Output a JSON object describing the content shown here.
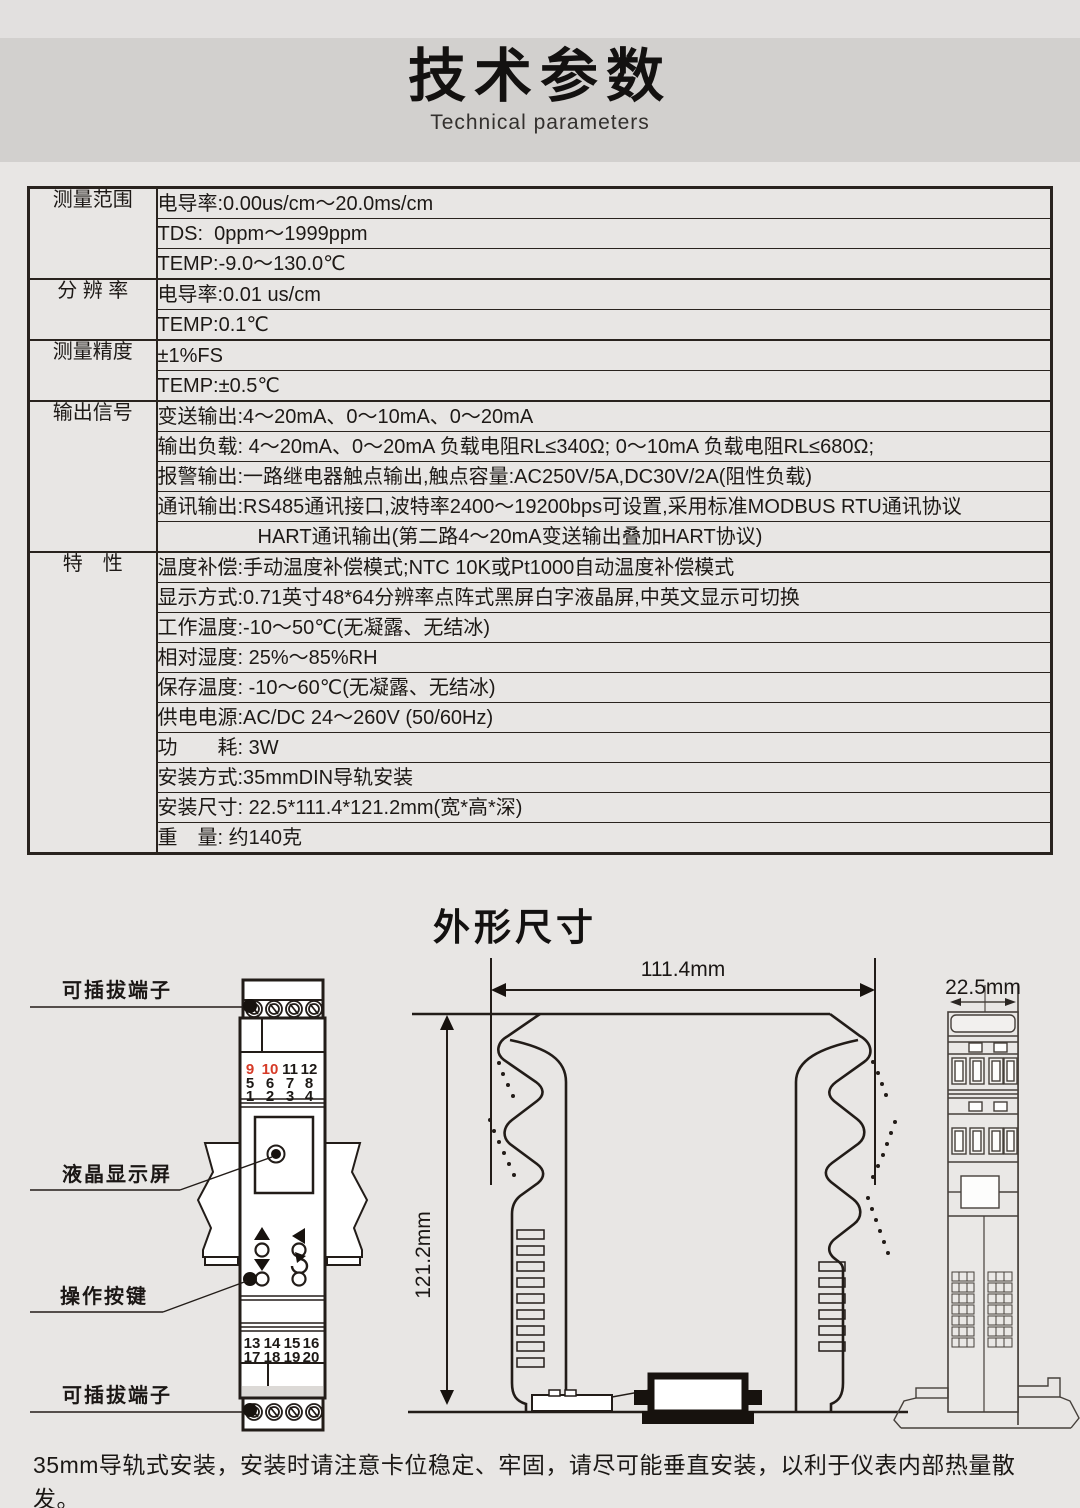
{
  "page": {
    "title": "技术参数",
    "subtitle": "Technical parameters",
    "footer": "35mm导轨式安装，安装时请注意卡位稳定、牢固，请尽可能垂直安装，以利于仪表内部热量散发。"
  },
  "colors": {
    "accent_red": "#d63a27",
    "line": "#29231e"
  },
  "spec_table": {
    "groups": [
      {
        "label": "测量范围",
        "rows": [
          {
            "t": "电导率:0.00us/cm～20.0ms/cm"
          },
          {
            "t": "TDS:  0ppm～1999ppm"
          },
          {
            "t": "TEMP:-9.0～130.0℃"
          }
        ]
      },
      {
        "label": "分 辨 率",
        "rows": [
          {
            "t": "电导率:0.01 us/cm"
          },
          {
            "t": "TEMP:0.1℃"
          }
        ]
      },
      {
        "label": "测量精度",
        "rows": [
          {
            "t": "±1%FS"
          },
          {
            "t": "TEMP:±0.5℃"
          }
        ]
      },
      {
        "label": "输出信号",
        "rows": [
          {
            "t": "变送输出:4～20mA、0～10mA、0～20mA"
          },
          {
            "t": "输出负载: 4～20mA、0～20mA 负载电阻RL≤340Ω; 0～10mA 负载电阻RL≤680Ω;"
          },
          {
            "t": "报警输出:一路继电器触点输出,触点容量:AC250V/5A,DC30V/2A(阻性负载)"
          },
          {
            "t": "通讯输出:RS485通讯接口,波特率2400～19200bps可设置,采用标准MODBUS RTU通讯协议"
          },
          {
            "t": "HART通讯输出(第二路4～20mA变送输出叠加HART协议)",
            "c": true
          }
        ]
      },
      {
        "label": "特　性",
        "rows": [
          {
            "t": "温度补偿:手动温度补偿模式;NTC 10K或Pt1000自动温度补偿模式"
          },
          {
            "t": "显示方式:0.71英寸48*64分辨率点阵式黑屏白字液晶屏,中英文显示可切换"
          },
          {
            "t": "工作温度:-10～50℃(无凝露、无结冰)"
          },
          {
            "t": "相对湿度: 25%～85%RH"
          },
          {
            "t": "保存温度: -10～60℃(无凝露、无结冰)"
          },
          {
            "t": "供电电源:AC/DC 24～260V (50/60Hz)"
          },
          {
            "t": "功　　耗: 3W"
          },
          {
            "t": "安装方式:35mmDIN导轨安装"
          },
          {
            "t": "安装尺寸: 22.5*111.4*121.2mm(宽*高*深)"
          },
          {
            "t": "重　量: 约140克"
          }
        ]
      }
    ]
  },
  "outline": {
    "title": "外形尺寸",
    "labels": {
      "terminal_top": "可插拔端子",
      "lcd": "液晶显示屏",
      "buttons": "操作按键",
      "terminal_bottom": "可插拔端子"
    },
    "dims": {
      "width": "111.4mm",
      "height": "121.2mm",
      "depth": "22.5mm"
    },
    "front_terminals_top": [
      "9",
      "10",
      "11",
      "12",
      "5",
      "6",
      "7",
      "8",
      "1",
      "2",
      "3",
      "4"
    ],
    "front_terminals_bottom": [
      "13",
      "14",
      "15",
      "16",
      "17",
      "18",
      "19",
      "20"
    ]
  }
}
